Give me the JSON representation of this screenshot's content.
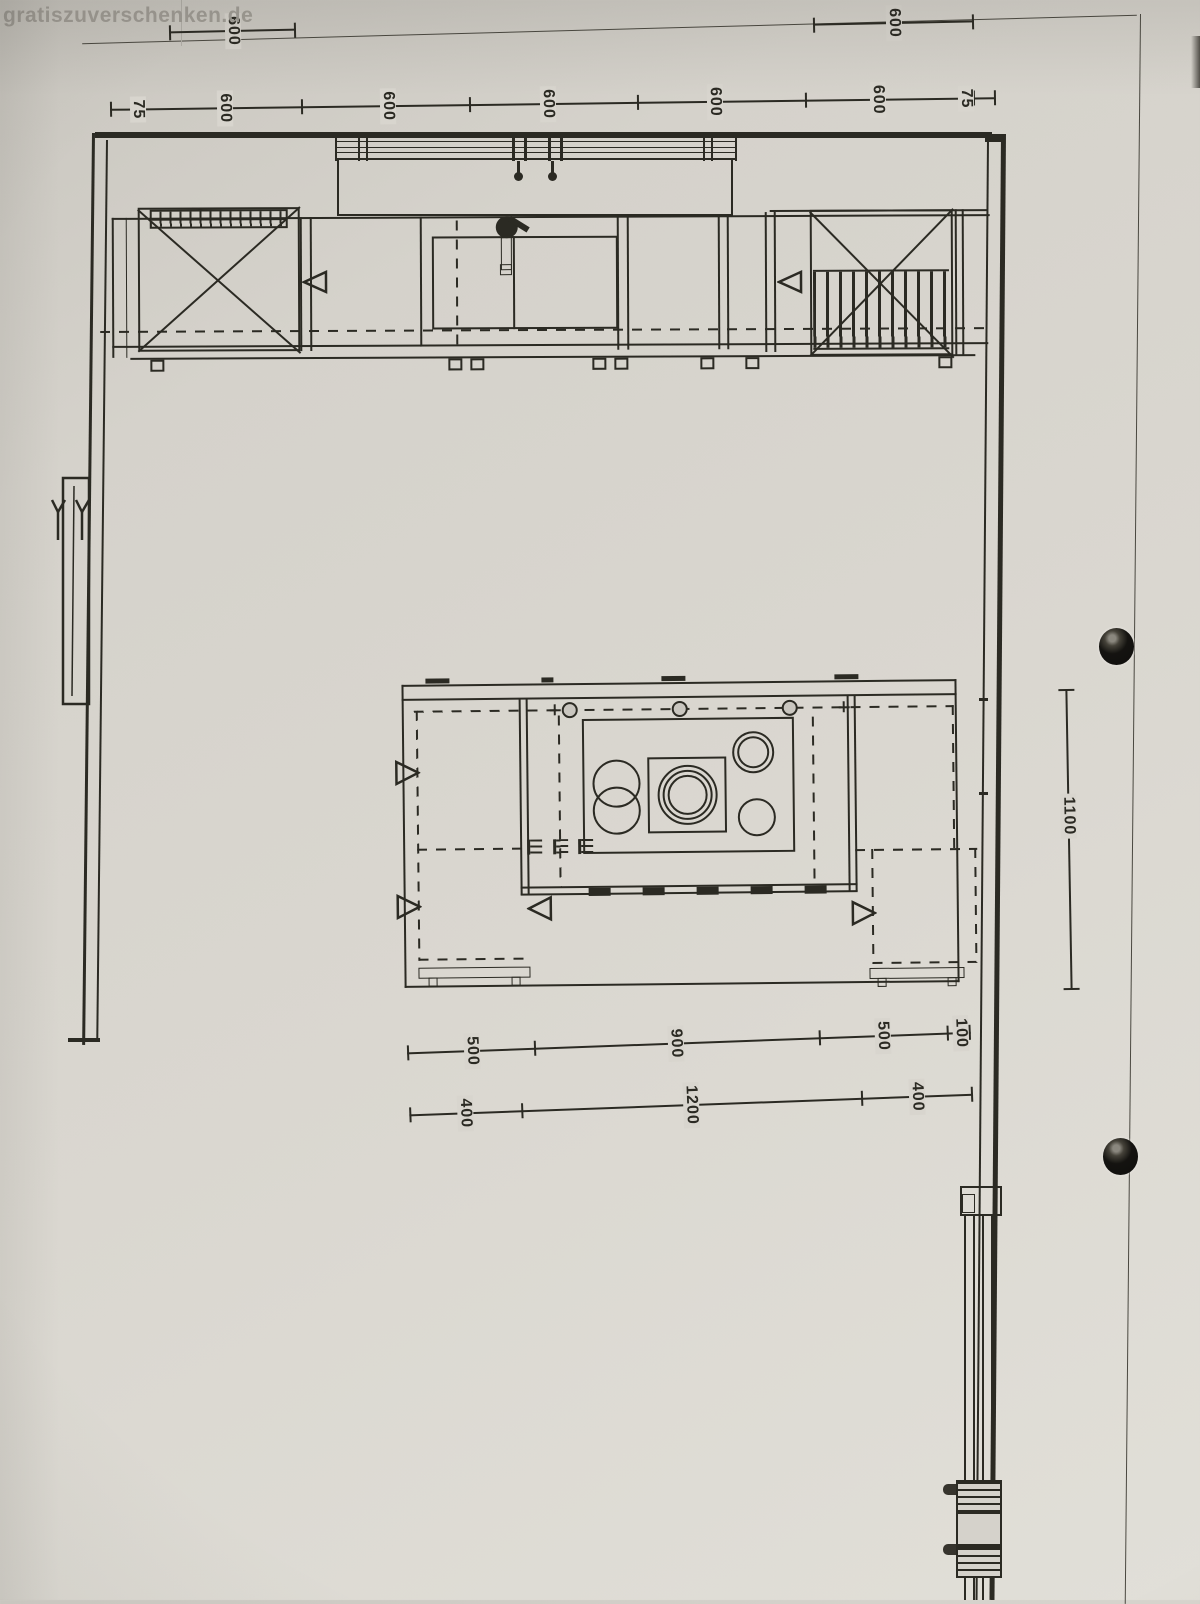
{
  "watermark": {
    "text": "gratiszuverschenken.de"
  },
  "colors": {
    "paper": "#d8d5ce",
    "ink": "#2b2a23",
    "watermark_gray": "#9e9b94",
    "frame_line": "#6b6860",
    "punch_hole": "#141310"
  },
  "dims": {
    "top_row1": [
      "600",
      "600"
    ],
    "top_row2": [
      "75",
      "600",
      "600",
      "600",
      "600",
      "600",
      "75"
    ],
    "right": [
      "1100"
    ],
    "bottom_row1": [
      "500",
      "900",
      "500",
      "100"
    ],
    "bottom_row2": [
      "400",
      "1200",
      "400"
    ]
  },
  "icons": {
    "door-swing-triangle-icon": "hollow triangle",
    "punch-hole": "filled dark circle",
    "faucet-icon": "filled circle with lever",
    "burner-icon": "concentric circles",
    "appliance-cross-icon": "X diagonals",
    "vent-grille-icon": "hatched strip"
  }
}
